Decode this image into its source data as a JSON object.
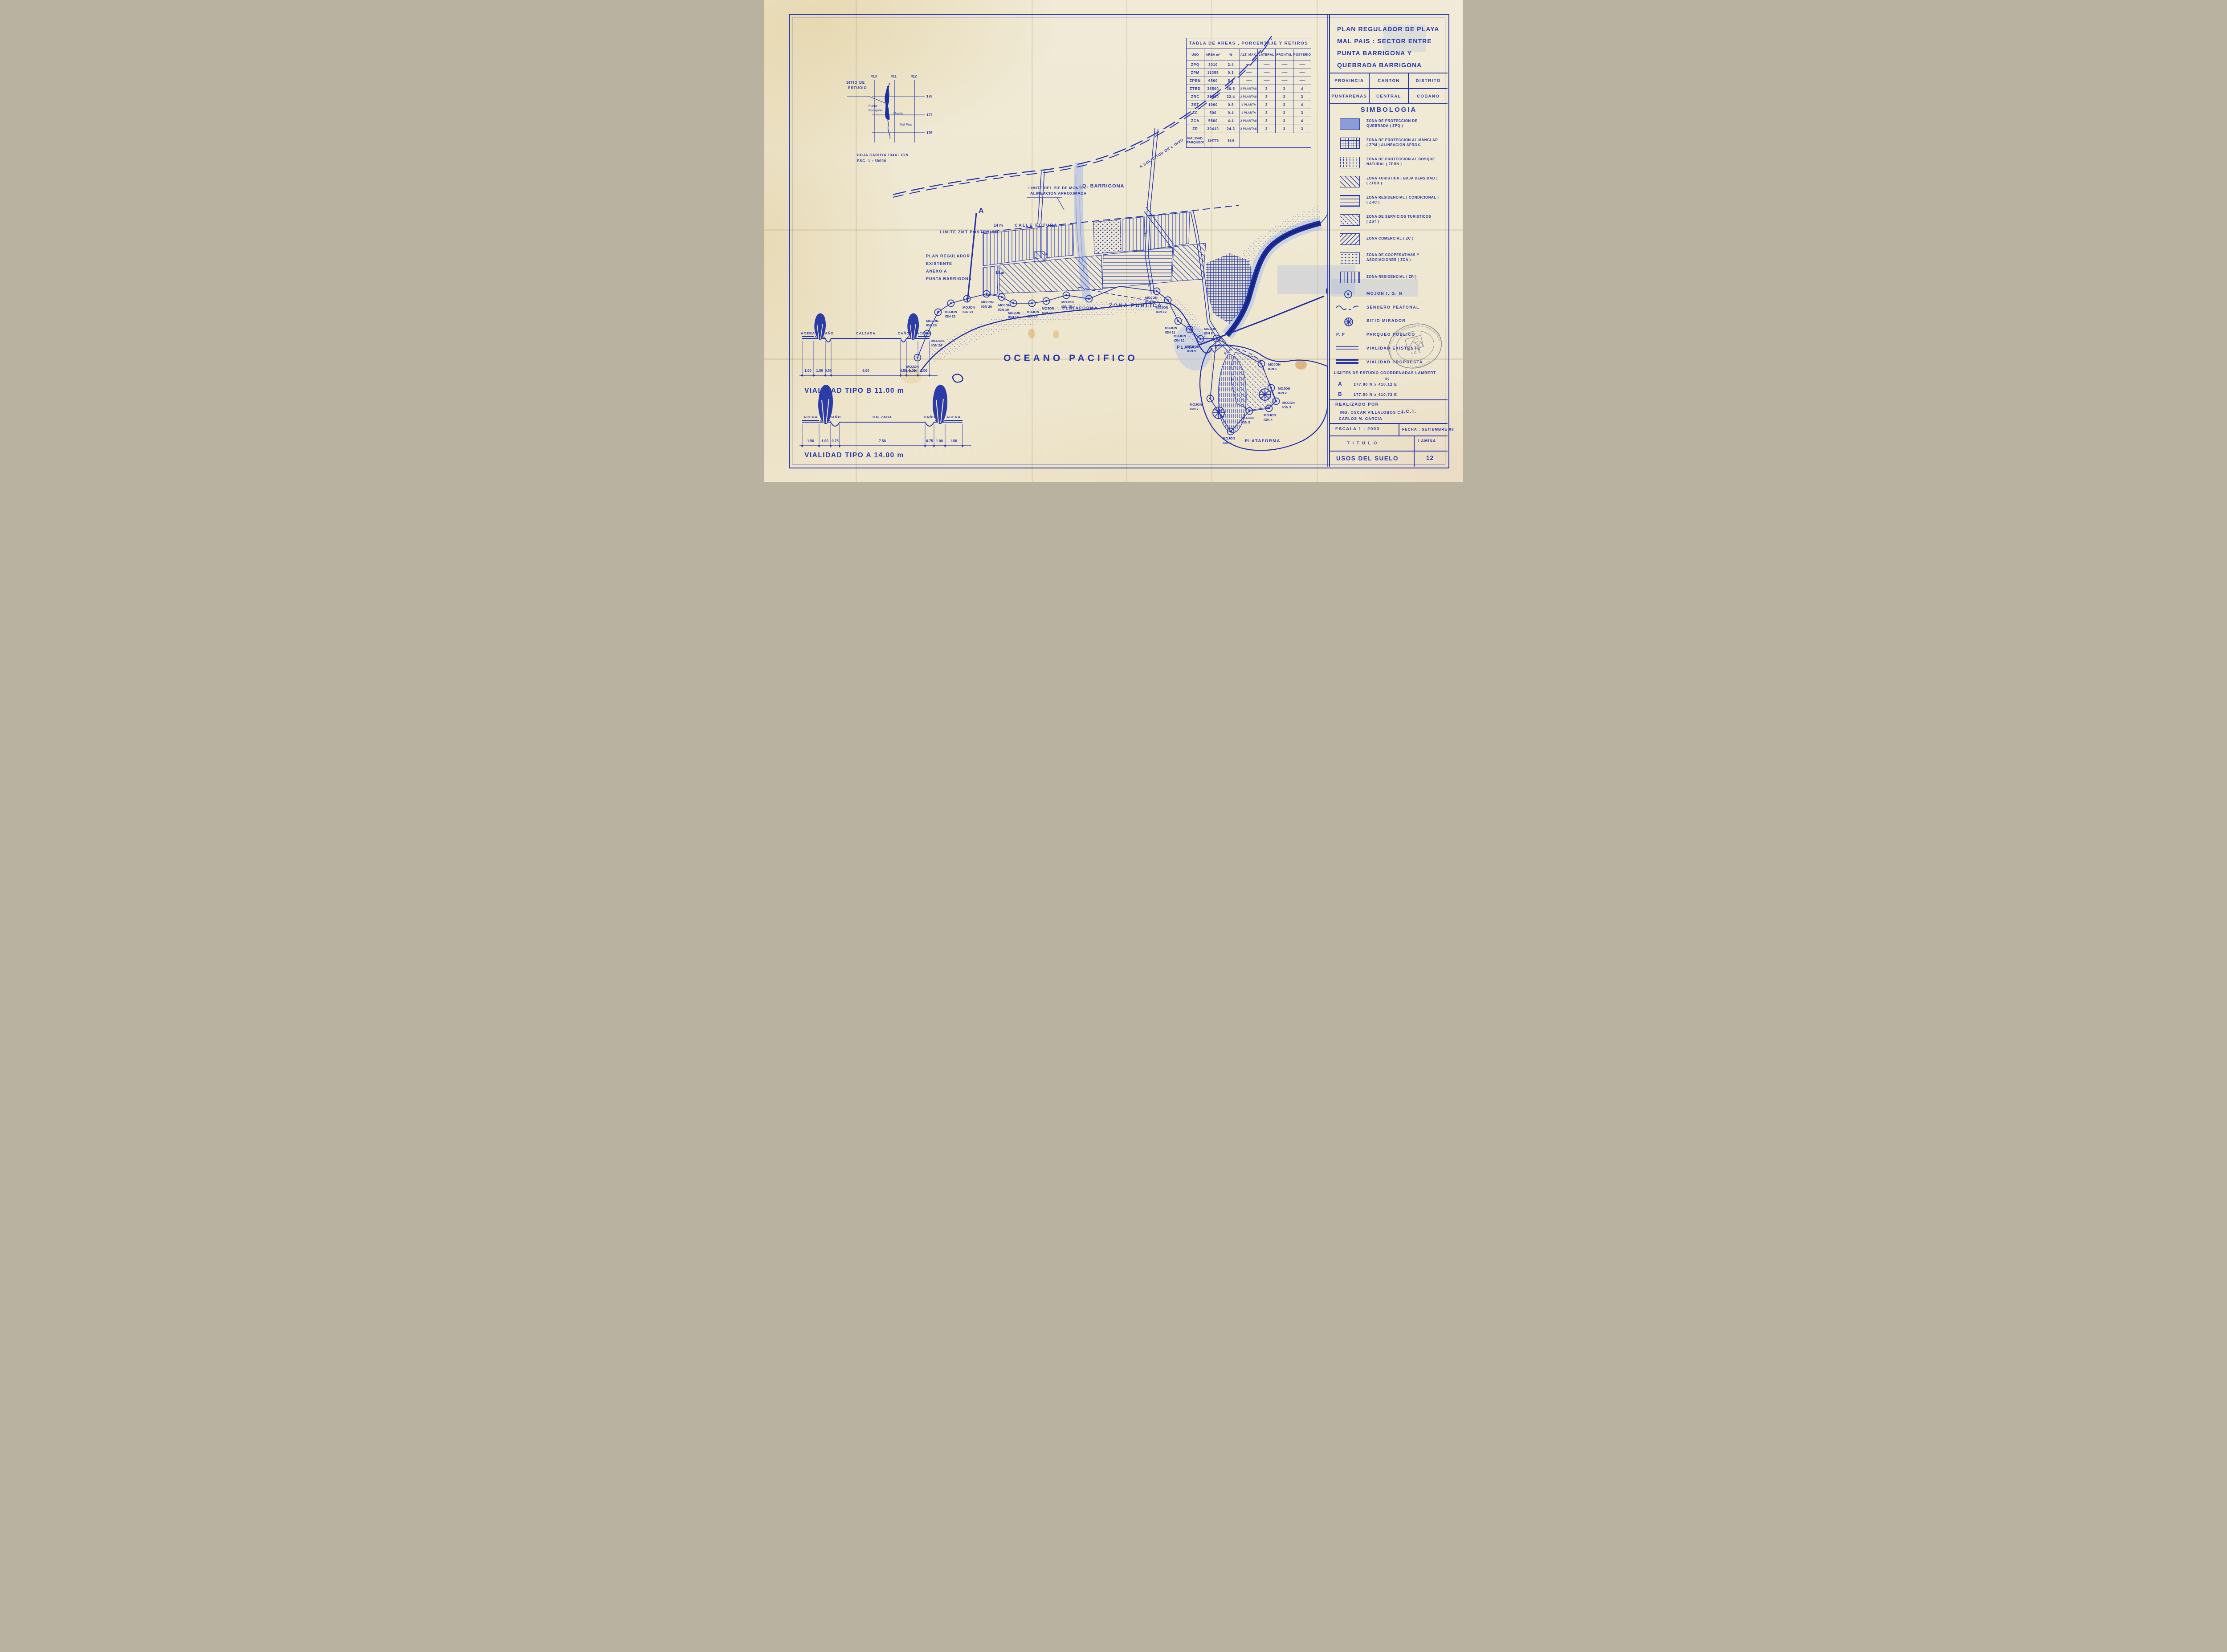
{
  "title_block": {
    "line1": "PLAN REGULADOR DE PLAYA",
    "line2": "MAL PAIS : SECTOR ENTRE",
    "line3": "PUNTA BARRIGONA Y",
    "line4": "QUEBRADA BARRIGONA"
  },
  "admin": {
    "h1": "PROVINCIA",
    "h2": "CANTON",
    "h3": "DISTRITO",
    "v1": "PUNTARENAS",
    "v2": "CENTRAL",
    "v3": "COBANO"
  },
  "simbologia": {
    "title": "SIMBOLOGIA",
    "zones": [
      {
        "key": "ZPQ",
        "line1": "ZONA DE PROTECCION DE",
        "line2": "QUEBRADA  ( ZPQ )"
      },
      {
        "key": "ZPM",
        "line1": "ZONA DE PROTECCION AL MANGLAR",
        "line2": "( ZPM ) ALINEACION APROX."
      },
      {
        "key": "ZPBN",
        "line1": "ZONA DE PROTECCION AL BOSQUE",
        "line2": "NATURAL ( ZPBN )"
      },
      {
        "key": "ZTBD",
        "line1": "ZONA TURISTICA ( BAJA DENSIDAD )",
        "line2": "( ZTBD )"
      },
      {
        "key": "ZRC",
        "line1": "ZONA RESIDENCIAL ( CONDICIONAL )",
        "line2": "( ZRC )"
      },
      {
        "key": "ZST",
        "line1": "ZONA DE SERVICIOS TURISTICOS",
        "line2": "( ZST )"
      },
      {
        "key": "ZC",
        "line1": "ZONA COMERCIAL  ( ZC )",
        "line2": ""
      },
      {
        "key": "ZCA",
        "line1": "ZONA DE COOPERATIVAS Y",
        "line2": "ASOCIACIONES ( ZCA )"
      },
      {
        "key": "ZR",
        "line1": "ZONA RESIDENCIAL ( ZR )",
        "line2": ""
      }
    ],
    "symbols": [
      {
        "label": "MOJON  I. G. N"
      },
      {
        "label": "SENDERO PEATONAL"
      },
      {
        "label": "SITIO MIRADOR"
      },
      {
        "prefix": "P. P",
        "label": "PARQUEO PUBLICO"
      },
      {
        "label": "VIALIDAD EXISTENTE"
      },
      {
        "label": "VIALIDAD PROPUESTA"
      }
    ]
  },
  "limites": {
    "heading": "LIMITES DE ESTUDIO COORDENADAS LAMBERT",
    "a_id": "A",
    "a_coord": "177.80 N  x  410.12 E",
    "a_sup": "80",
    "b_id": "B",
    "b_coord": "177.50 N  x  410.72 E"
  },
  "realizado": {
    "heading": "REALIZADO POR",
    "name1": "ING.  OSCAR VILLALOBOS CH.",
    "org": "I.C.T.",
    "name2": "CARLOS  M.  GARCIA"
  },
  "footer": {
    "escala": "ESCALA  1 : 2000",
    "fecha": "FECHA : SETIEMBRE  98",
    "titulo_label": "T I T U L O",
    "lamina_label": "LAMINA",
    "titulo": "USOS  DEL  SUELO",
    "lamina": "12"
  },
  "stamp": {
    "arc_top": "DIRECCION DE PLANEAMIENTO Y DESARROLLO",
    "arc_bottom": "TURISTICO",
    "org": "I. C. T."
  },
  "areas_table": {
    "title": "TABLA  DE  AREAS , PORCENTAJE  Y  RETIROS",
    "columns": [
      "USO",
      "AREA m²",
      "%",
      "ALT. MAX.",
      "LATERAL",
      "FRONTAL",
      "POSTERIOR"
    ],
    "rows": [
      [
        "ZPQ",
        "3010",
        "2.4",
        "——",
        "——",
        "——",
        "——"
      ],
      [
        "ZPM",
        "11355",
        "9.1",
        "——",
        "——",
        "——",
        "——"
      ],
      [
        "ZPBN",
        "6500",
        "5.2",
        "——",
        "——",
        "——",
        "——"
      ],
      [
        "ZTBD",
        "38500",
        "30.8",
        "2 PLANTAS",
        "3",
        "3",
        "4"
      ],
      [
        "ZRC",
        "28000",
        "22.4",
        "2 PLANTAS",
        "3",
        "3",
        "3"
      ],
      [
        "ZST",
        "1000",
        "0.8",
        "1 PLANTA",
        "3",
        "3",
        "4"
      ],
      [
        "ZC",
        "500",
        "0.4",
        "1 PLANTA",
        "3",
        "3",
        "3"
      ],
      [
        "ZCA",
        "5500",
        "4.4",
        "2 PLANTAS",
        "3",
        "3",
        "4"
      ],
      [
        "ZR",
        "30410",
        "24.3",
        "2 PLANTAS",
        "3",
        "3",
        "3"
      ]
    ],
    "footer_row": {
      "uso1": "VIALIDAD.",
      "uso2": "PARQUEOS",
      "area": "124775",
      "pct": "99.8"
    }
  },
  "inset": {
    "sitio1": "SITIO DE",
    "sitio2": "ESTUDIO",
    "punta1": "Punta",
    "punta2": "Barrigona",
    "muelle": "Muelle",
    "malpais": "Mal Pais",
    "x1": "410",
    "x2": "411",
    "x3": "412",
    "y1": "178",
    "y2": "177",
    "y3": "176",
    "caption1": "HOJA CABUYA 1344 I IGN",
    "caption2": "ESC. 1 : 50000"
  },
  "sections": {
    "b": {
      "title": "VIALIDAD  TIPO B    11.00 m",
      "labels": [
        "ACERA",
        "CAÑO",
        "CALZADA",
        "CAÑO",
        "ACERA"
      ],
      "dims": [
        "1.00",
        "1.00",
        "0.50",
        "6.00",
        "0.50",
        "1.00",
        "1.00"
      ]
    },
    "a": {
      "title": "VIALIDAD  TIPO  A   14.00 m",
      "labels": [
        "ACERA",
        "CAÑO",
        "CALZADA",
        "CAÑO",
        "ACERA"
      ],
      "dims": [
        "1.50",
        "1.00",
        "0.75",
        "7.50",
        "0.75",
        "1.00",
        "1.50"
      ]
    }
  },
  "map": {
    "oceano": "OCEANO  PACIFICO",
    "zona_publica": "ZONA  PUBLICA",
    "plataforma_left": "PLATAFORMA",
    "plataforma_right": "PLATAFORMA",
    "playa": "PLAYA",
    "limite_zmt": "LIMITE  ZMT  POSTERIOR",
    "plan1": "PLAN  REGULADOR",
    "plan2": "EXISTENTE",
    "plan3": "ANEXO  A",
    "plan4": "PUNTA  BARRIGONA",
    "pie1": "LIMITE DEL PIE DE MONTE",
    "pie2": "ALINEACION  APROXIMADA",
    "qbarrigona": "Q. BARRIGONA",
    "invu": "A  SOLICITUD  DE L  INVU",
    "calle_m": "14 m",
    "calle": "CALLE  FUTURA",
    "road14": "14 m",
    "road14r": "14m",
    "road11": "11m",
    "road9": "9.0 m",
    "pp": "P.P",
    "p1": "P",
    "p2": "P",
    "a_marker": "A",
    "b_marker": "B",
    "mojones": [
      {
        "l1": "MOJON",
        "l2": "IGN 25"
      },
      {
        "l1": "MOJON",
        "l2": "IGN 24"
      },
      {
        "l1": "MOJON",
        "l2": "IGN 23"
      },
      {
        "l1": "MOJON",
        "l2": "IGN 22"
      },
      {
        "l1": "MOJON",
        "l2": "IGN 21"
      },
      {
        "l1": "MOJON",
        "l2": "IGN 20"
      },
      {
        "l1": "MOJON",
        "l2": "IGN 19"
      },
      {
        "l1": "MOJON",
        "l2": "IGN 18"
      },
      {
        "l1": "MOJON",
        "l2": "IGN 17"
      },
      {
        "l1": "MOJON",
        "l2": "IGN 16"
      },
      {
        "l1": "MOJON",
        "l2": "IGN 15."
      },
      {
        "l1": "MOJON",
        "l2": "IGN 13"
      },
      {
        "l1": "MOJON",
        "l2": "IGN 12"
      },
      {
        "l1": "MOJON",
        "l2": "IGN 11"
      },
      {
        "l1": "MOJON",
        "l2": "IGN 10"
      },
      {
        "l1": "MOJON",
        "l2": "IGN 9"
      },
      {
        "l1": "MOJON",
        "l2": "IGN 8"
      },
      {
        "l1": "MOJON",
        "l2": "IGN 1"
      },
      {
        "l1": "MOJON",
        "l2": "IGN 2"
      },
      {
        "l1": "MOJON",
        "l2": "IGN 3"
      },
      {
        "l1": "MOJON",
        "l2": "IGN 4"
      },
      {
        "l1": "MOJON",
        "l2": "IGN 5"
      },
      {
        "l1": "MOJON",
        "l2": "IGN 6"
      },
      {
        "l1": "MOJON",
        "l2": "IGN 7"
      }
    ]
  }
}
